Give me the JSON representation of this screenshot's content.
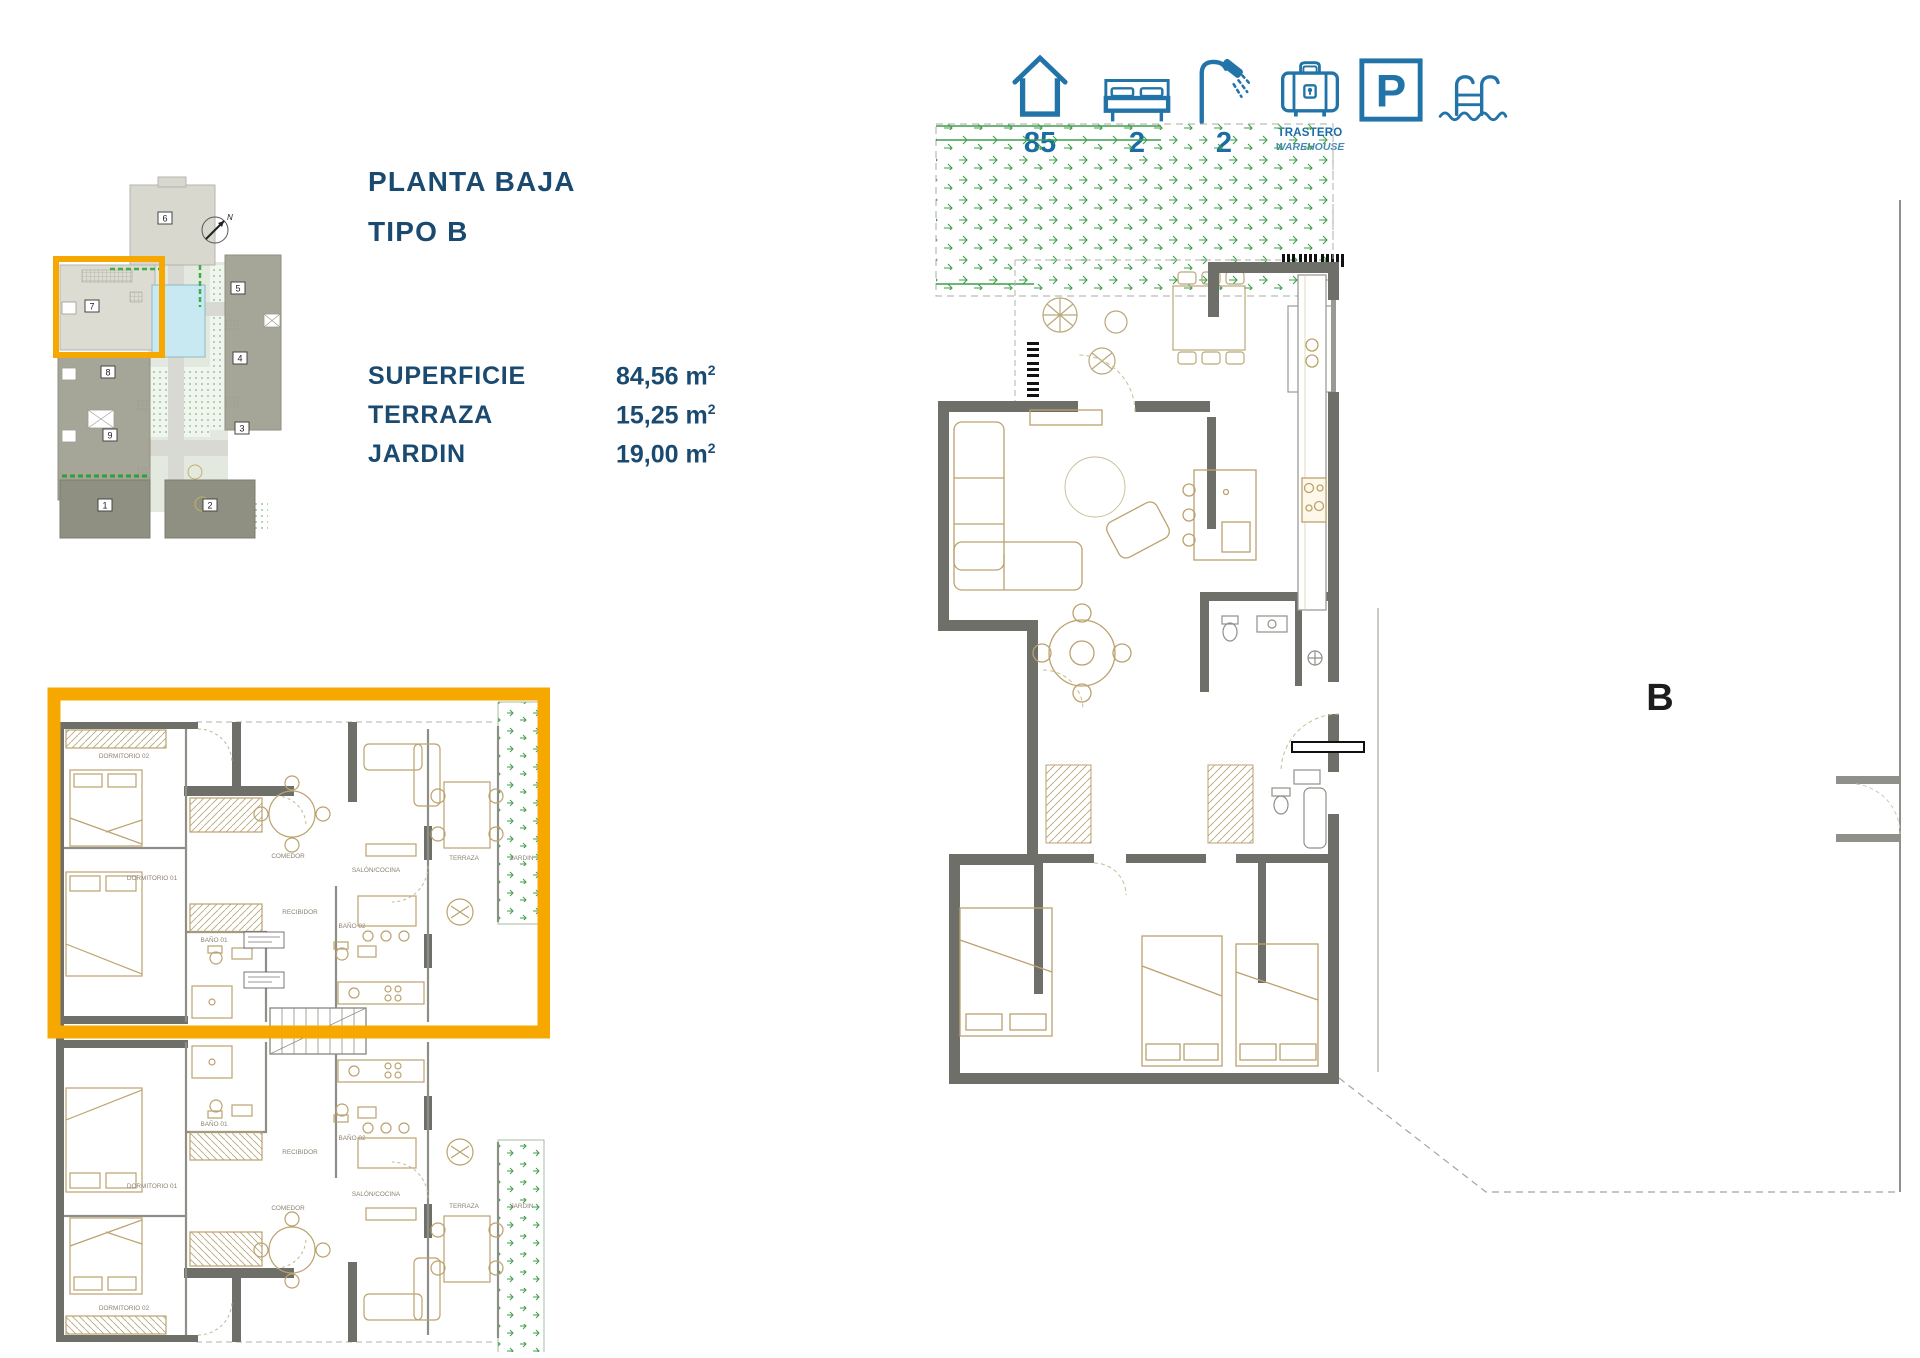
{
  "header": {
    "title_line1": "PLANTA BAJA",
    "title_line2": "TIPO B"
  },
  "specs": {
    "rows": [
      {
        "label": "SUPERFICIE",
        "value": "84,56 m",
        "sup": "2"
      },
      {
        "label": "TERRAZA",
        "value": "15,25 m",
        "sup": "2"
      },
      {
        "label": "JARDIN",
        "value": "19,00 m",
        "sup": "2"
      }
    ]
  },
  "amenities": {
    "house_count": "85",
    "bed_count": "2",
    "shower_count": "2",
    "storage_label_line1": "TRASTERO",
    "storage_label_line2": "WAREHOUSE",
    "parking_letter": "P"
  },
  "site_plan": {
    "compass_label": "N",
    "highlighted_unit": "7",
    "units": [
      "1",
      "2",
      "3",
      "4",
      "5",
      "6",
      "7",
      "8",
      "9"
    ]
  },
  "floor_plan_left": {
    "rooms": {
      "dormitorio01": "DORMITORIO 01",
      "dormitorio02": "DORMITORIO 02",
      "bano01": "BAÑO 01",
      "bano02": "BAÑO 02",
      "recibidor": "RECIBIDOR",
      "comedor": "COMEDOR",
      "salon_cocina": "SALÓN/COCINA",
      "terraza": "TERRAZA",
      "jardin": "JARDIN"
    }
  },
  "floor_plan_right": {
    "unit_label": "B"
  },
  "colors": {
    "accent_navy": "#1b4a70",
    "icon_blue": "#2173a8",
    "highlight_orange": "#f7a800",
    "wall_gray": "#6f6f6a",
    "furniture_tan": "#bba26e",
    "garden_green": "#3f9e4b",
    "pool_blue": "#c8e9f2"
  }
}
